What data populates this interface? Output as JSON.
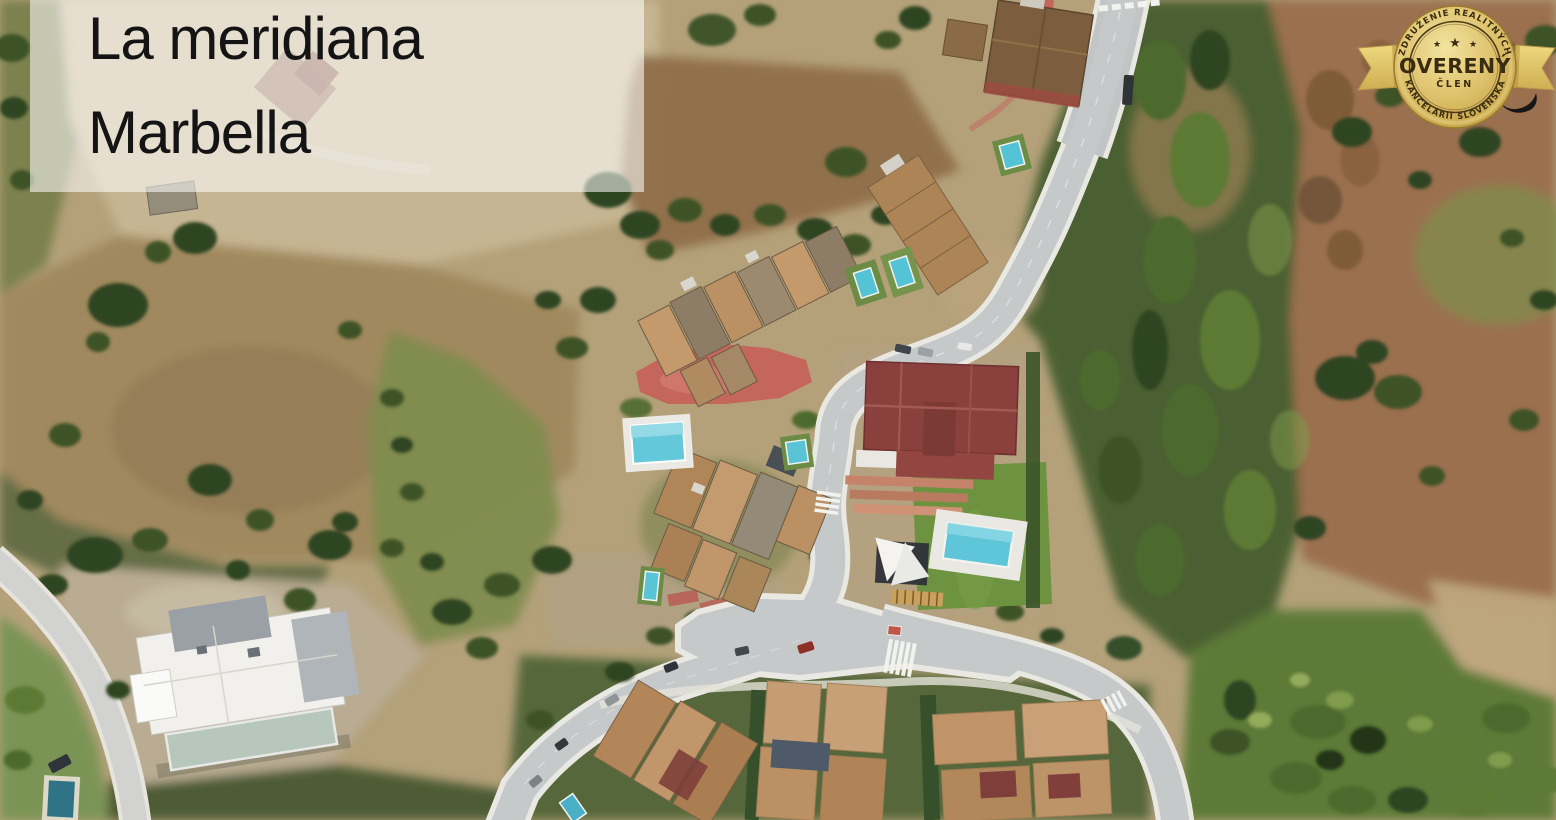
{
  "location_card": {
    "name": "La meridiana",
    "city": "Marbella"
  },
  "badge": {
    "arc_top": "ZDRUŽENIE REALITNÝCH",
    "title": "OVERENÝ",
    "subtitle": "ČLEN",
    "arc_bottom": "KANCELÁRIÍ SLOVENSKA",
    "star": "★",
    "colors": {
      "gold_light": "#f1e09c",
      "gold": "#d9ba62",
      "gold_dark": "#a8862f",
      "text_dark": "#3a2c10"
    }
  },
  "map": {
    "kind": "satellite-aerial-photo",
    "colors": {
      "terrain_tan": "#b6a379",
      "scrub_brown": "#96794f",
      "forest_green": "#4b6132",
      "olive_field": "#7f8c4f",
      "road_gray": "#c6c9c9",
      "sidewalk_white": "#e9e8e2",
      "pool_turquoise": "#5fc6da",
      "roof_terracotta": "#b58c62",
      "villa_roof_red": "#8a403d",
      "plaza_red": "#c4665c",
      "lawn_green": "#6d9340"
    }
  }
}
